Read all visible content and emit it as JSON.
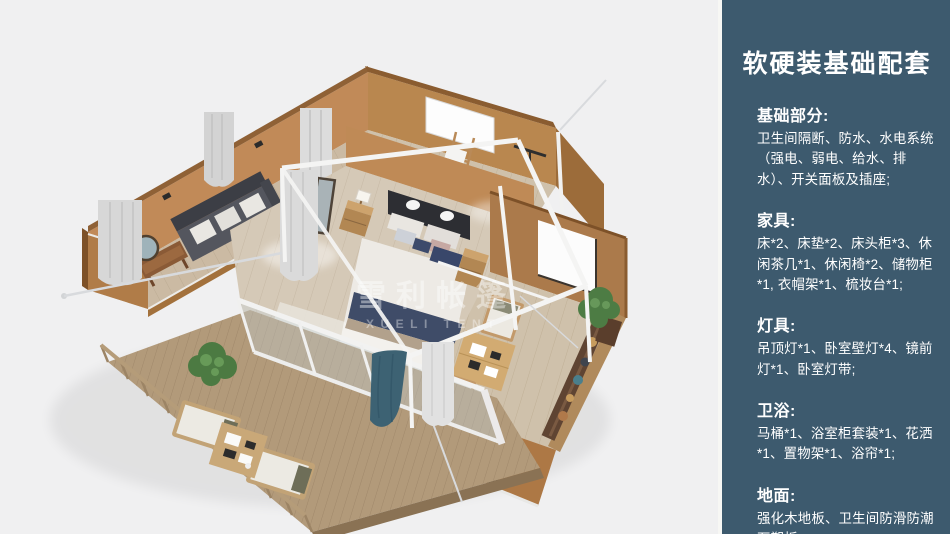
{
  "panel": {
    "title": "软硬装基础配套",
    "background_color": "#3d5a6e",
    "text_color": "#ffffff",
    "sections": [
      {
        "heading": "基础部分:",
        "body": "卫生间隔断、防水、水电系统（强电、弱电、给水、排水）、开关面板及插座;"
      },
      {
        "heading": "家具:",
        "body": "床*2、床垫*2、床头柜*3、休闲茶几*1、休闲椅*2、储物柜*1, 衣帽架*1、梳妆台*1;"
      },
      {
        "heading": "灯具:",
        "body": "吊顶灯*1、卧室壁灯*4、镜前灯*1、卧室灯带;"
      },
      {
        "heading": "卫浴:",
        "body": "马桶*1、浴室柜套装*1、花洒*1、置物架*1、浴帘*1;"
      },
      {
        "heading": "地面:",
        "body": "强化木地板、卫生间防滑防潮石塑板;"
      }
    ]
  },
  "illustration": {
    "watermark": {
      "cn": "雪利帐篷",
      "en": "XUELI TENT"
    },
    "background_color": "#f0f0f1",
    "wall_color": "#b9874f",
    "floor_color": "#d5c9b7",
    "deck_color": "#b29a7a",
    "accent_navy": "#3f4c68",
    "accent_teal": "#3d6273"
  }
}
